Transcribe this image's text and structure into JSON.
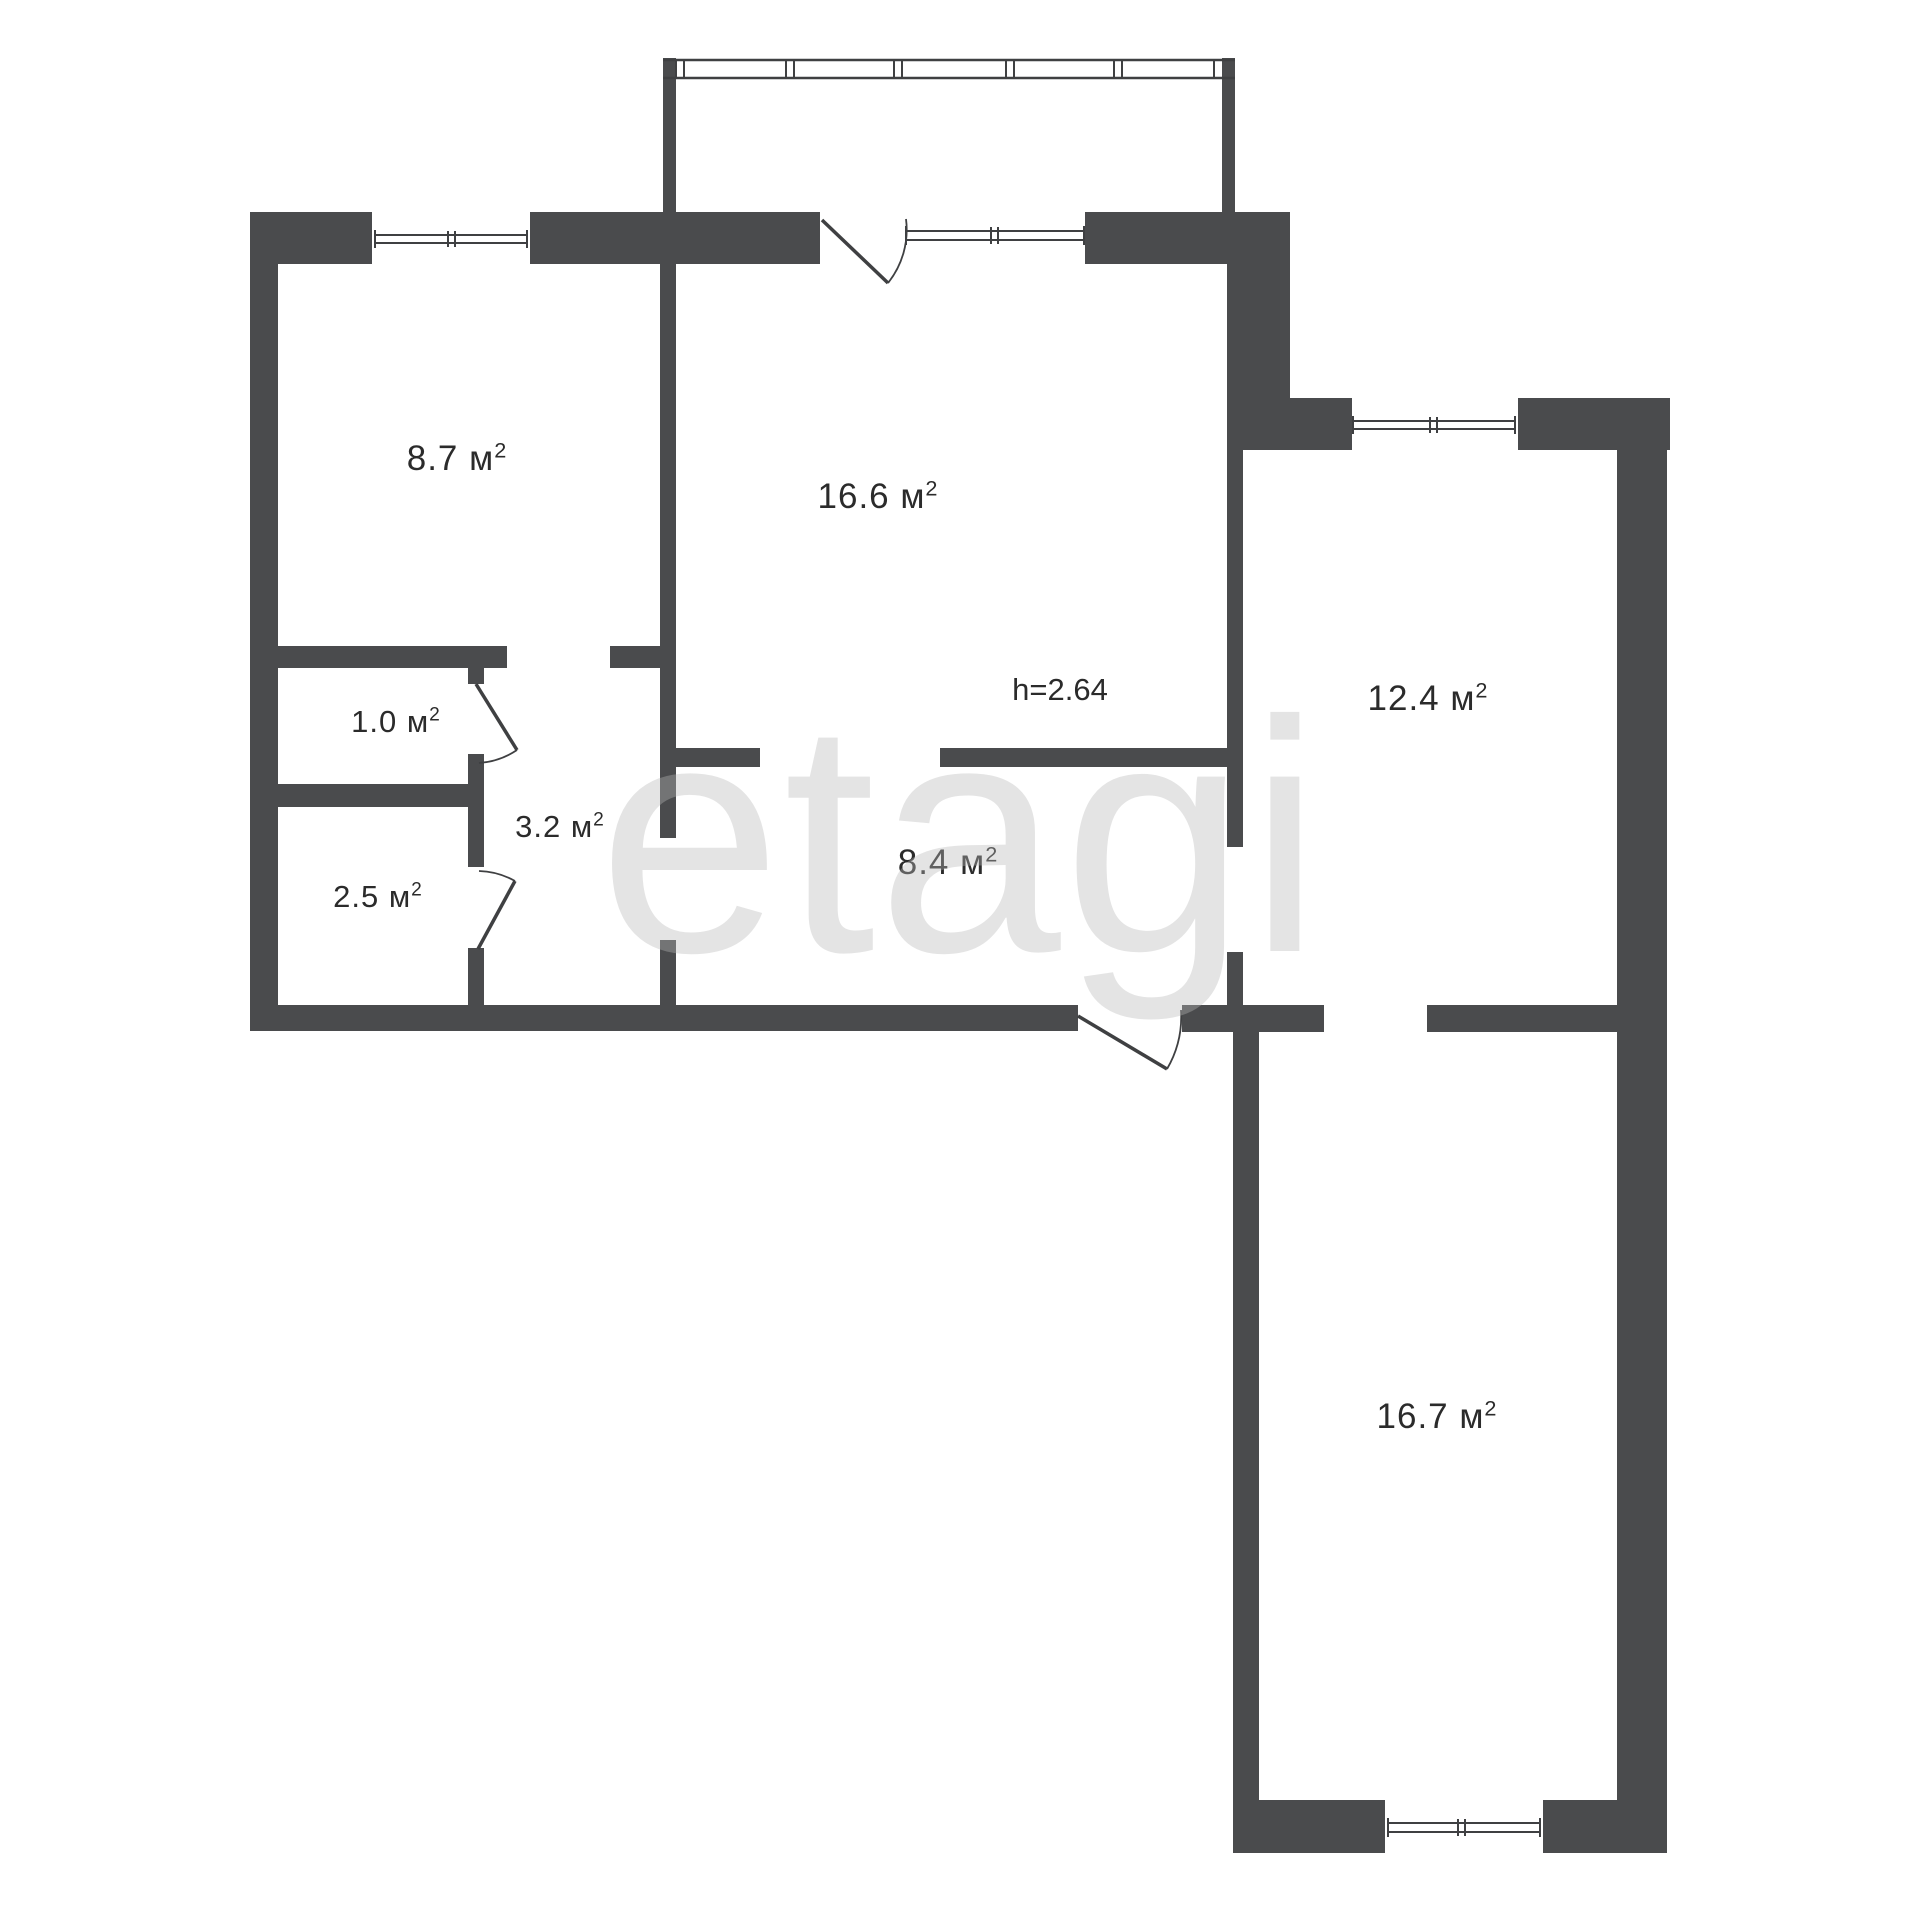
{
  "plan": {
    "name": "apartment-floor-plan",
    "watermark": "etagi",
    "height_note": "h=2.64",
    "unit": "м",
    "sup": "2",
    "rooms": [
      {
        "id": "room-8-7",
        "area": "8.7",
        "unit": "м",
        "sup": "2"
      },
      {
        "id": "room-16-6",
        "area": "16.6",
        "unit": "м",
        "sup": "2"
      },
      {
        "id": "room-12-4",
        "area": "12.4",
        "unit": "м",
        "sup": "2"
      },
      {
        "id": "room-1-0",
        "area": "1.0",
        "unit": "м",
        "sup": "2"
      },
      {
        "id": "room-3-2",
        "area": "3.2",
        "unit": "м",
        "sup": "2"
      },
      {
        "id": "room-2-5",
        "area": "2.5",
        "unit": "м",
        "sup": "2"
      },
      {
        "id": "room-8-4",
        "area": "8.4",
        "unit": "м",
        "sup": "2"
      },
      {
        "id": "room-16-7",
        "area": "16.7",
        "unit": "м",
        "sup": "2"
      }
    ],
    "colors": {
      "wall": "#4a4b4d",
      "line": "#3f4042",
      "text": "#2b2b2b",
      "background": "#ffffff",
      "watermark": "#b9b9b9"
    }
  }
}
